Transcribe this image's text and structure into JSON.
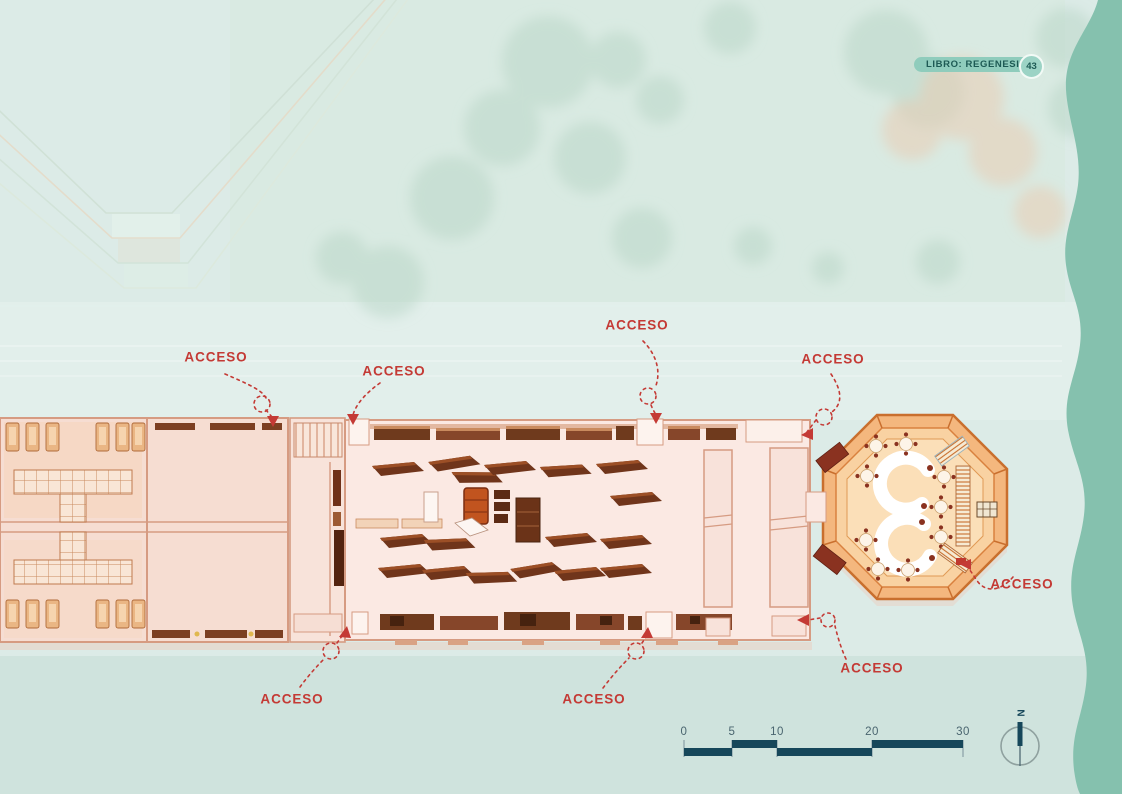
{
  "header": {
    "badge_label": "LIBRO: REGENESIS",
    "page_number": "43"
  },
  "access_points": [
    {
      "id": "top-left",
      "label": "ACCESO"
    },
    {
      "id": "top-left-2",
      "label": "ACCESO"
    },
    {
      "id": "top-center",
      "label": "ACCESO"
    },
    {
      "id": "top-right",
      "label": "ACCESO"
    },
    {
      "id": "octagon-east",
      "label": "ACCESO"
    },
    {
      "id": "bottom-right",
      "label": "ACCESO"
    },
    {
      "id": "bottom-left",
      "label": "ACCESO"
    },
    {
      "id": "bottom-center",
      "label": "ACCESO"
    }
  ],
  "scale_bar": {
    "tick_labels": [
      "0",
      "5",
      "10",
      "20",
      "30"
    ]
  },
  "compass": {
    "north_label": "N"
  },
  "colors": {
    "background": "#dcebe7",
    "accent_red": "#c43a35",
    "teal_edge": "#85c1ae",
    "badge_bg": "#8fccbc",
    "badge_text": "#1d5a54",
    "scale_dark": "#16475a",
    "wall": "#d69b82",
    "plan_fill": "#fbe9e3",
    "octagon_fill": "#f4b77e",
    "octagon_line": "#c96f2e"
  }
}
